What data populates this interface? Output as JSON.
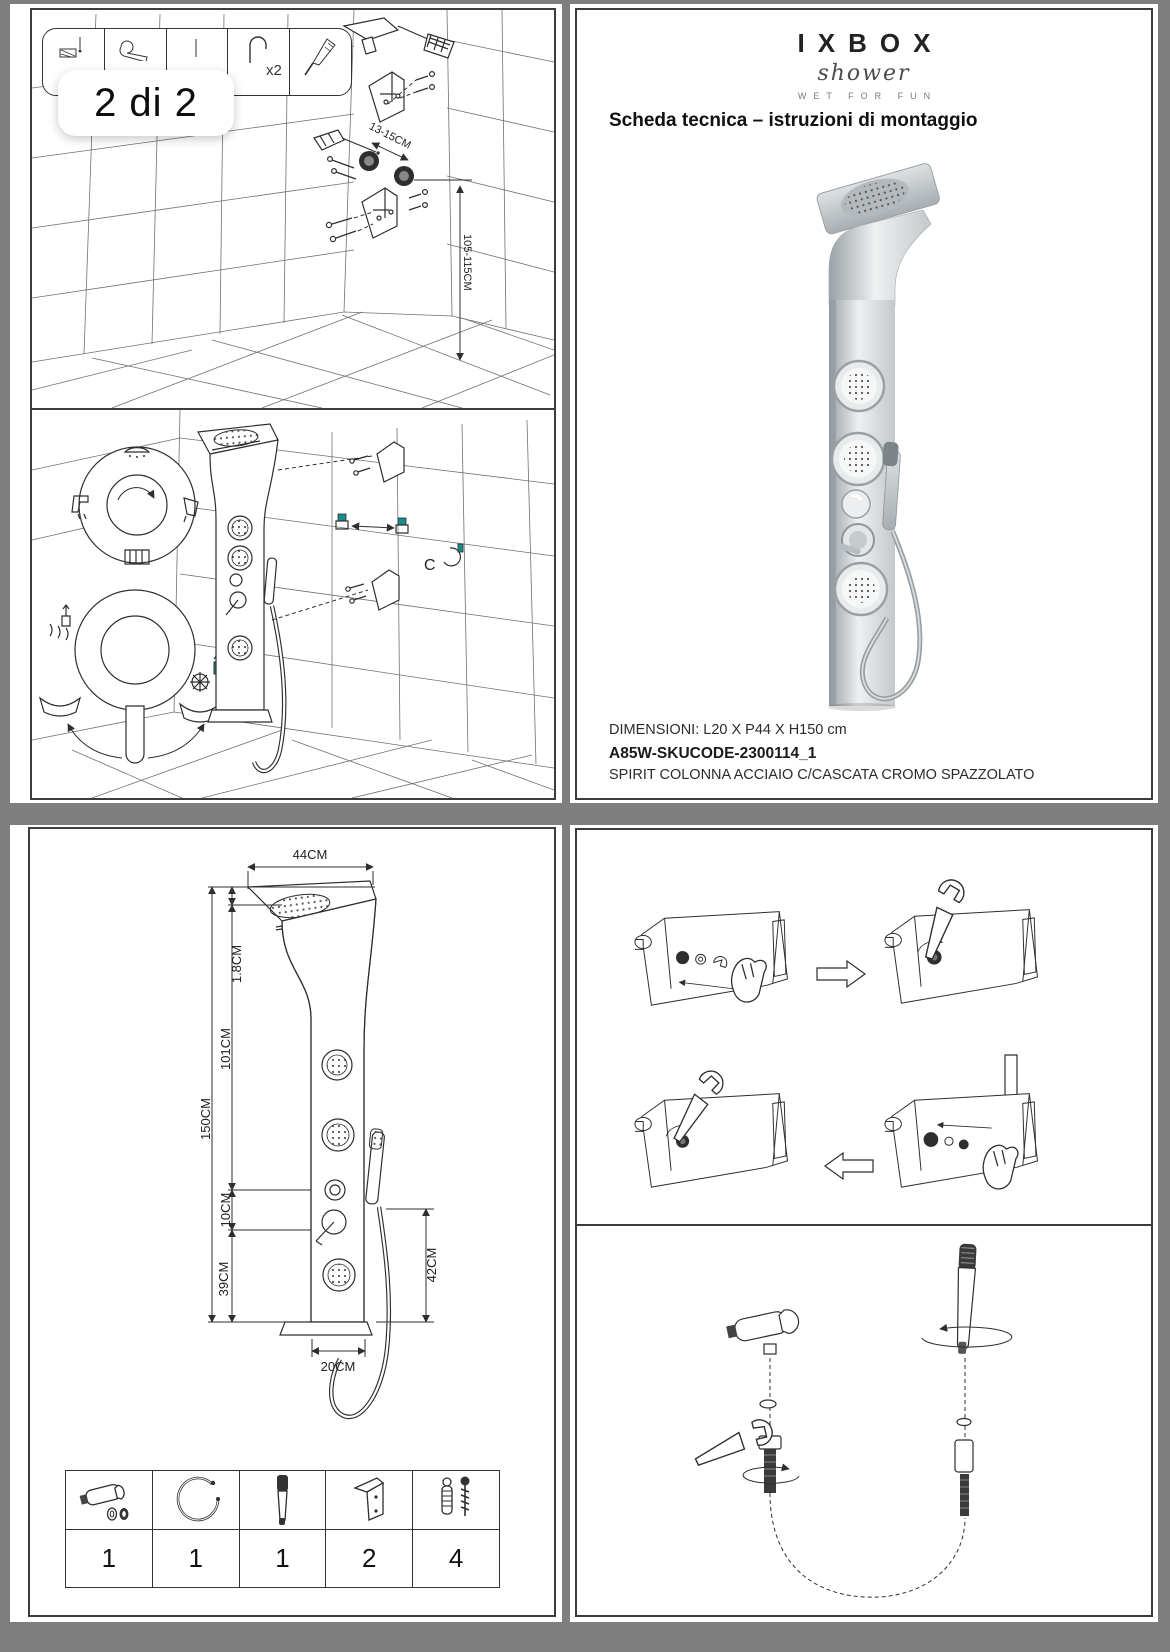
{
  "viewer": {
    "page_indicator": "2 di 2"
  },
  "colors": {
    "background": "#7e7e7e",
    "panel": "#ffffff",
    "line": "#2e2e2e",
    "accent_teal": "#188e8e"
  },
  "installation": {
    "toolbar_qty_label": "x2",
    "dim_bracket_spacing": "13-15CM",
    "dim_outlet_height": "105-115CM",
    "clip_label": "C"
  },
  "product": {
    "brand": "IXBOX",
    "brand_script": "shower",
    "tagline": "WET FOR FUN",
    "heading": "Scheda tecnica – istruzioni di montaggio",
    "dimensions_line": "DIMENSIONI: L20 X P44 X H150 cm",
    "sku": "A85W-SKUCODE-2300114_1",
    "product_name": "SPIRIT COLONNA ACCIAIO C/CASCATA CROMO SPAZZOLATO"
  },
  "dimension_labels": {
    "width_top": "44CM",
    "head_thickness": "1.8CM",
    "upper_height": "101CM",
    "total_height": "150CM",
    "mid_gap": "10CM",
    "lower_height": "39CM",
    "hose_drop": "42CM",
    "body_width": "20CM"
  },
  "parts_table": {
    "items": [
      {
        "name": "handshower holder with washers",
        "qty": "1"
      },
      {
        "name": "shower hose",
        "qty": "1"
      },
      {
        "name": "hand shower",
        "qty": "1"
      },
      {
        "name": "wall bracket",
        "qty": "2"
      },
      {
        "name": "screws and anchors",
        "qty": "4"
      }
    ]
  }
}
